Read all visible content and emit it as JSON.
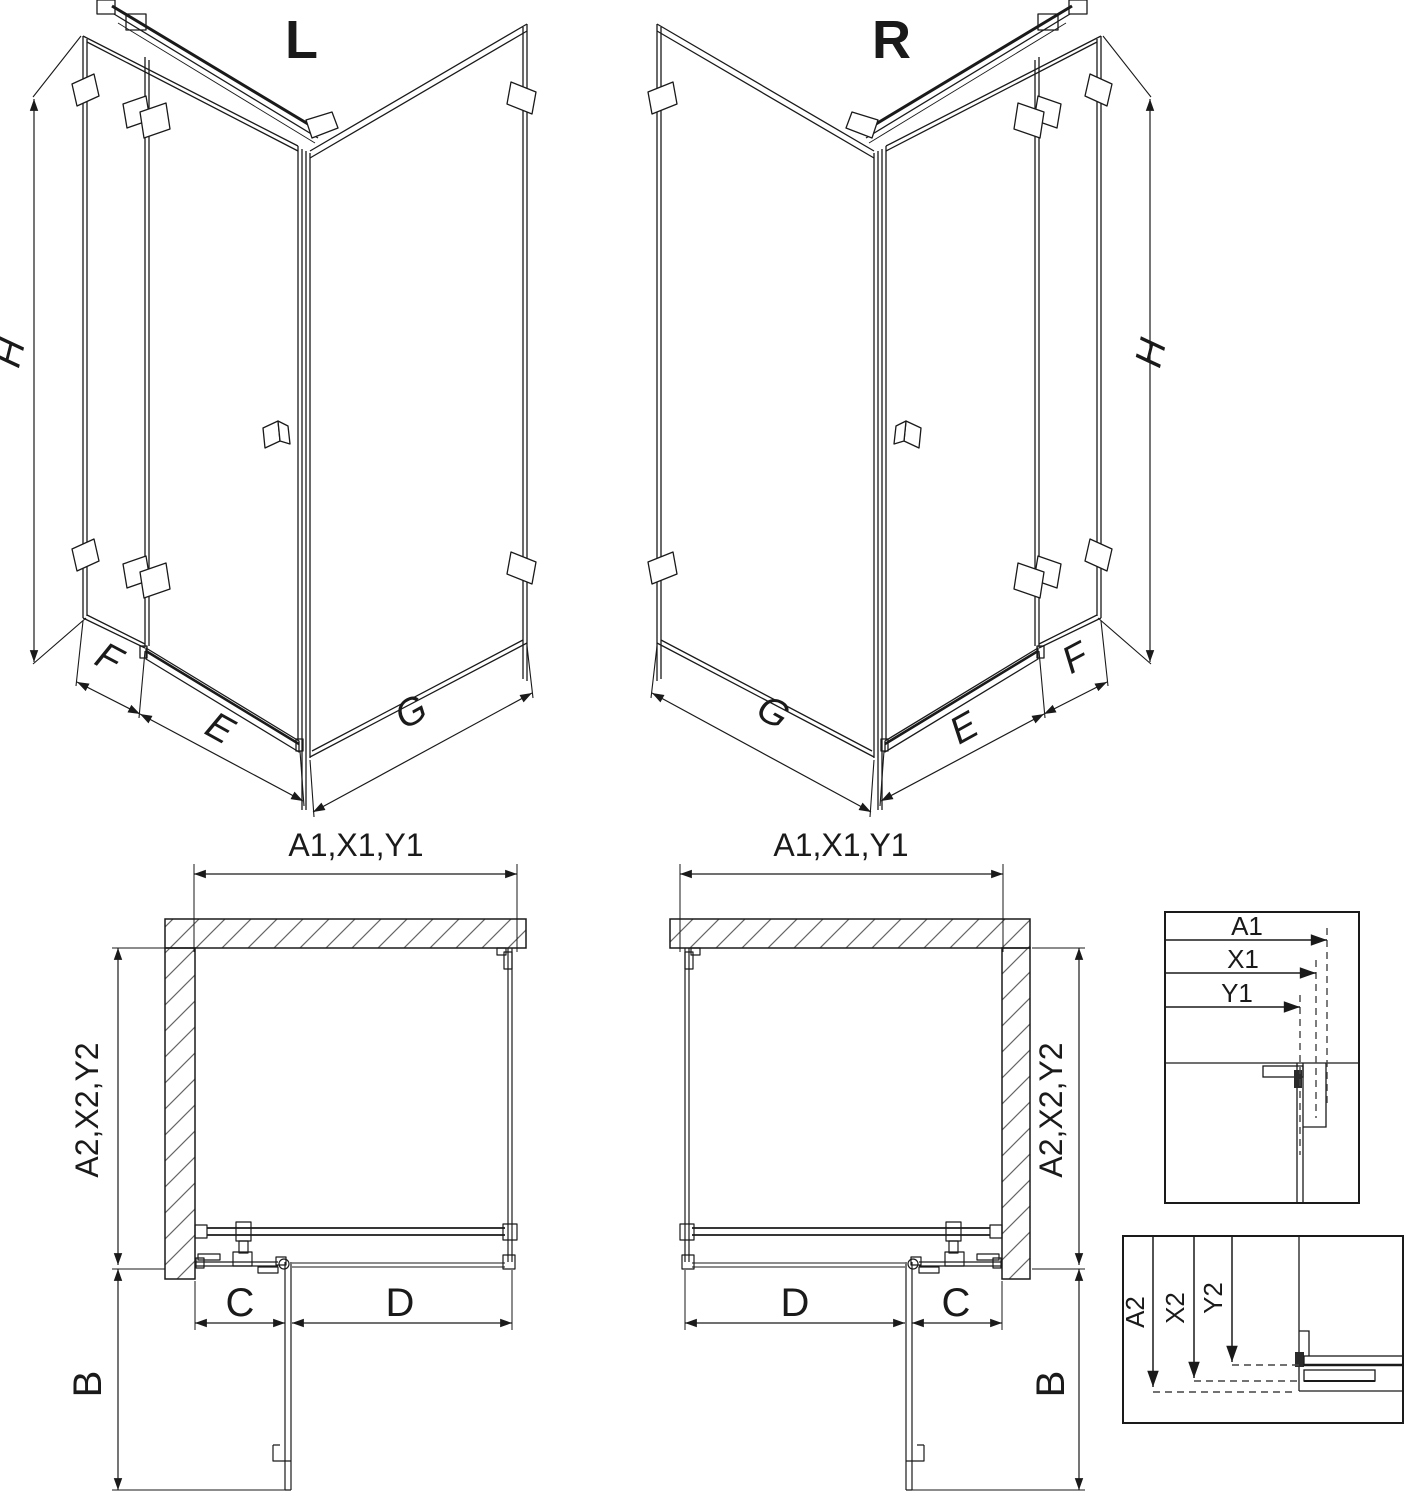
{
  "page": {
    "background": "#ffffff",
    "line_color": "#1a1a1a",
    "hatch_color": "#666666"
  },
  "iso_left": {
    "label": "L",
    "height": "H",
    "fixed_width": "F",
    "door_width": "E",
    "side_width": "G"
  },
  "iso_right": {
    "label": "R",
    "height": "H",
    "fixed_width": "F",
    "door_width": "E",
    "side_width": "G"
  },
  "plan_left": {
    "width_top": "A1,X1,Y1",
    "depth_side": "A2,X2,Y2",
    "fixed_segment": "C",
    "door_segment": "D",
    "door_swing": "B"
  },
  "plan_right": {
    "width_top": "A1,X1,Y1",
    "depth_side": "A2,X2,Y2",
    "fixed_segment": "C",
    "door_segment": "D",
    "door_swing": "B"
  },
  "detail_width_box": {
    "a1": "A1",
    "x1": "X1",
    "y1": "Y1"
  },
  "detail_depth_box": {
    "a2": "A2",
    "x2": "X2",
    "y2": "Y2"
  }
}
